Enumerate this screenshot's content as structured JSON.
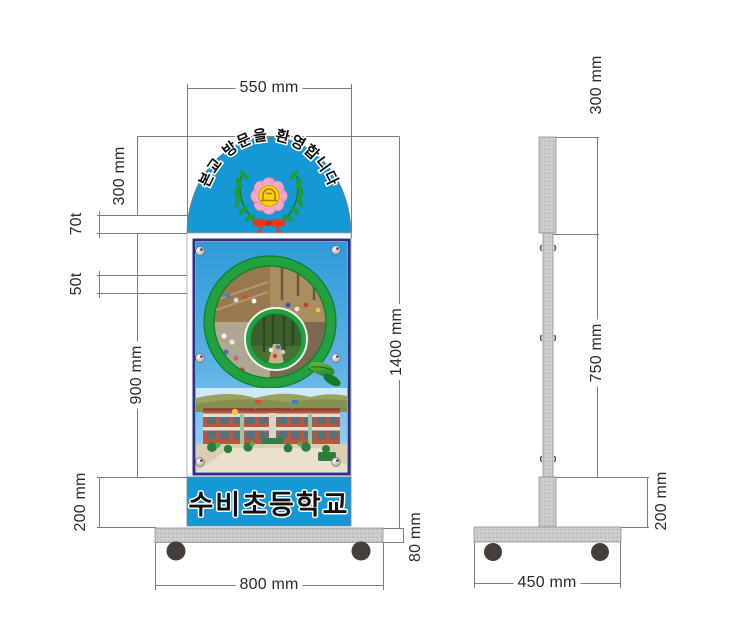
{
  "drawing_title": "school standing sign - dimensioned drawing",
  "front_view": {
    "arch_text": "본교 방문을 환영합니다",
    "school_name": "수비초등학교",
    "dims": {
      "top_width": "550 mm",
      "arch_height": "300 mm",
      "arch_thickness": "70t",
      "panel_thickness": "50t",
      "photo_panel_height": "900 mm",
      "name_band_height": "200 mm",
      "overall_height": "1400 mm",
      "base_plate_height": "80 mm",
      "base_width": "800 mm"
    }
  },
  "side_view": {
    "dims": {
      "header_height": "300 mm",
      "pole_height": "750 mm",
      "lower_section_height": "200 mm",
      "base_depth": "450 mm"
    }
  },
  "colors": {
    "sign_blue": "#1697d6",
    "frame_navy": "#2e3084",
    "ring_green": "#22a13e",
    "emblem_pink": "#f3a8ca",
    "emblem_yellow": "#ffd20a",
    "ribbon_red": "#e63a1d",
    "base_gray": "#cdcdcd",
    "wheel_gray": "#453f3c",
    "dimension_line": "#7d7d7d",
    "label_text": "#2b2b2b"
  }
}
